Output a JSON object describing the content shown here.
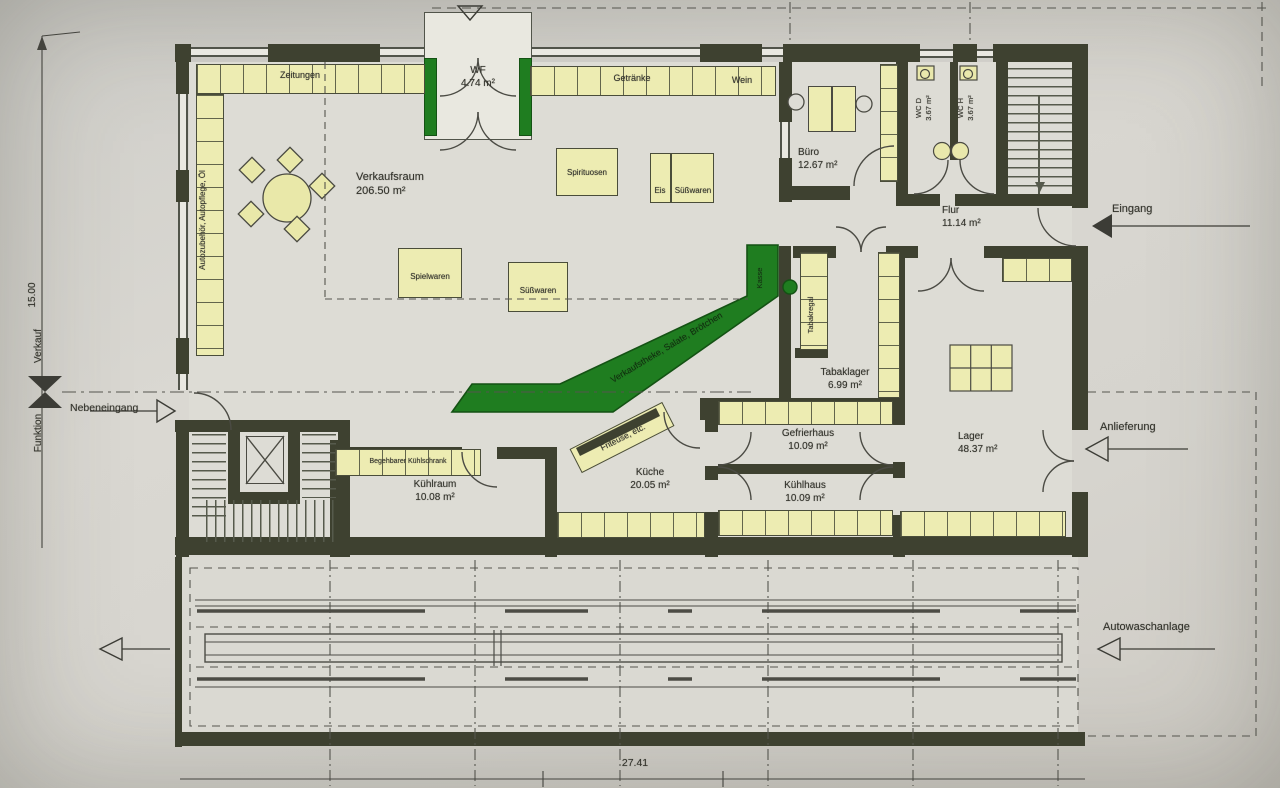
{
  "colors": {
    "wall": "#3e4130",
    "shelf": "#edecb2",
    "counter_green": "#1f7d20",
    "paper": "#d6d4ce"
  },
  "rooms": [
    {
      "name": "Verkaufsraum",
      "area": "206.50 m²"
    },
    {
      "name": "WF",
      "area": "4.74 m²"
    },
    {
      "name": "Büro",
      "area": "12.67 m²"
    },
    {
      "name": "WC D",
      "area": "3.67 m²"
    },
    {
      "name": "WC H",
      "area": "3.67 m²"
    },
    {
      "name": "Flur",
      "area": "11.14 m²"
    },
    {
      "name": "Tabaklager",
      "area": "6.99 m²"
    },
    {
      "name": "Lager",
      "area": "48.37 m²"
    },
    {
      "name": "Gefrierhaus",
      "area": "10.09 m²"
    },
    {
      "name": "Kühlhaus",
      "area": "10.09 m²"
    },
    {
      "name": "Küche",
      "area": "20.05 m²"
    },
    {
      "name": "Kühlraum",
      "area": "10.08 m²"
    }
  ],
  "shelves": {
    "zeitungen": "Zeitungen",
    "getraenke": "Getränke",
    "wein": "Wein",
    "spirituosen": "Spirituosen",
    "eis": "Eis",
    "suesswaren_island": "Süßwaren",
    "spielwaren": "Spielwaren",
    "suesswaren_island2": "Süßwaren",
    "autozubehoer": "Autozubehör, Autopflege, Öl",
    "tabakregal": "Tabakregal",
    "begehbarer_kuehlschrank": "Begehbarer Kühlschrank",
    "friteuse": "Friteuse, etc."
  },
  "counter": {
    "label": "Verkaufstheke, Salate, Brötchen",
    "kasse": "Kasse"
  },
  "annotations": {
    "eingang": "Eingang",
    "nebeneingang": "Nebeneingang",
    "anlieferung": "Anlieferung",
    "autowaschanlage": "Autowaschanlage",
    "funktion": "Funktion",
    "verkauf": "Verkauf"
  },
  "dimensions": {
    "total_width": "27.41",
    "total_height": "15.00"
  }
}
